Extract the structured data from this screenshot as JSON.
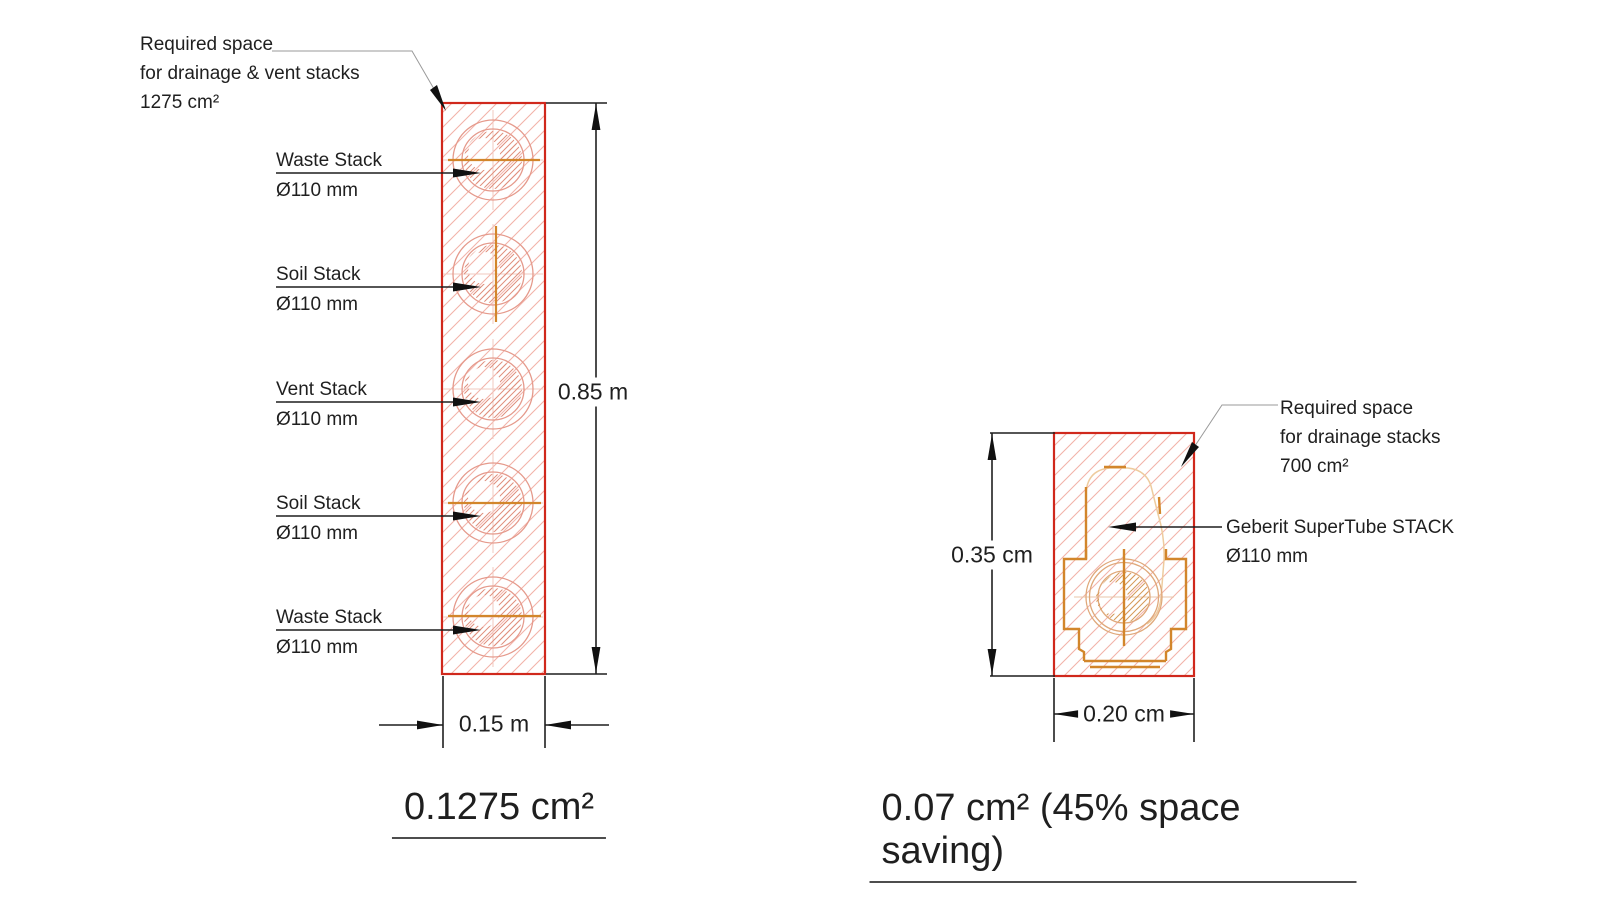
{
  "colors": {
    "background": "#ffffff",
    "wall_outline_red": "#d0281c",
    "wall_hatch_pink": "#f2b3aa",
    "pipe_outline_pink": "#e59a8c",
    "pipe_hatch_pink": "#df8f7d",
    "fitting_orange": "#d2862b",
    "fitting_light_orange": "#eecb9e",
    "dimension_black": "#1f1f1f",
    "leader_gray": "#9a9a9a"
  },
  "left": {
    "annotation_lines": [
      "Required space",
      "for drainage & vent stacks",
      "1275 cm²"
    ],
    "stacks": [
      {
        "name": "Waste Stack",
        "size": "Ø110 mm"
      },
      {
        "name": "Soil Stack",
        "size": "Ø110 mm"
      },
      {
        "name": "Vent Stack",
        "size": "Ø110 mm"
      },
      {
        "name": "Soil Stack",
        "size": "Ø110 mm"
      },
      {
        "name": "Waste Stack",
        "size": "Ø110 mm"
      }
    ],
    "height_dim": "0.85 m",
    "width_dim": "0.15 m",
    "area_label": "0.1275 cm²"
  },
  "right": {
    "annotation_lines": [
      "Required space",
      "for drainage stacks",
      "700 cm²"
    ],
    "product": {
      "name": "Geberit SuperTube STACK",
      "size": "Ø110 mm"
    },
    "height_dim": "0.35 cm",
    "width_dim": "0.20 cm",
    "area_label": "0.07 cm² (45% space saving)"
  }
}
